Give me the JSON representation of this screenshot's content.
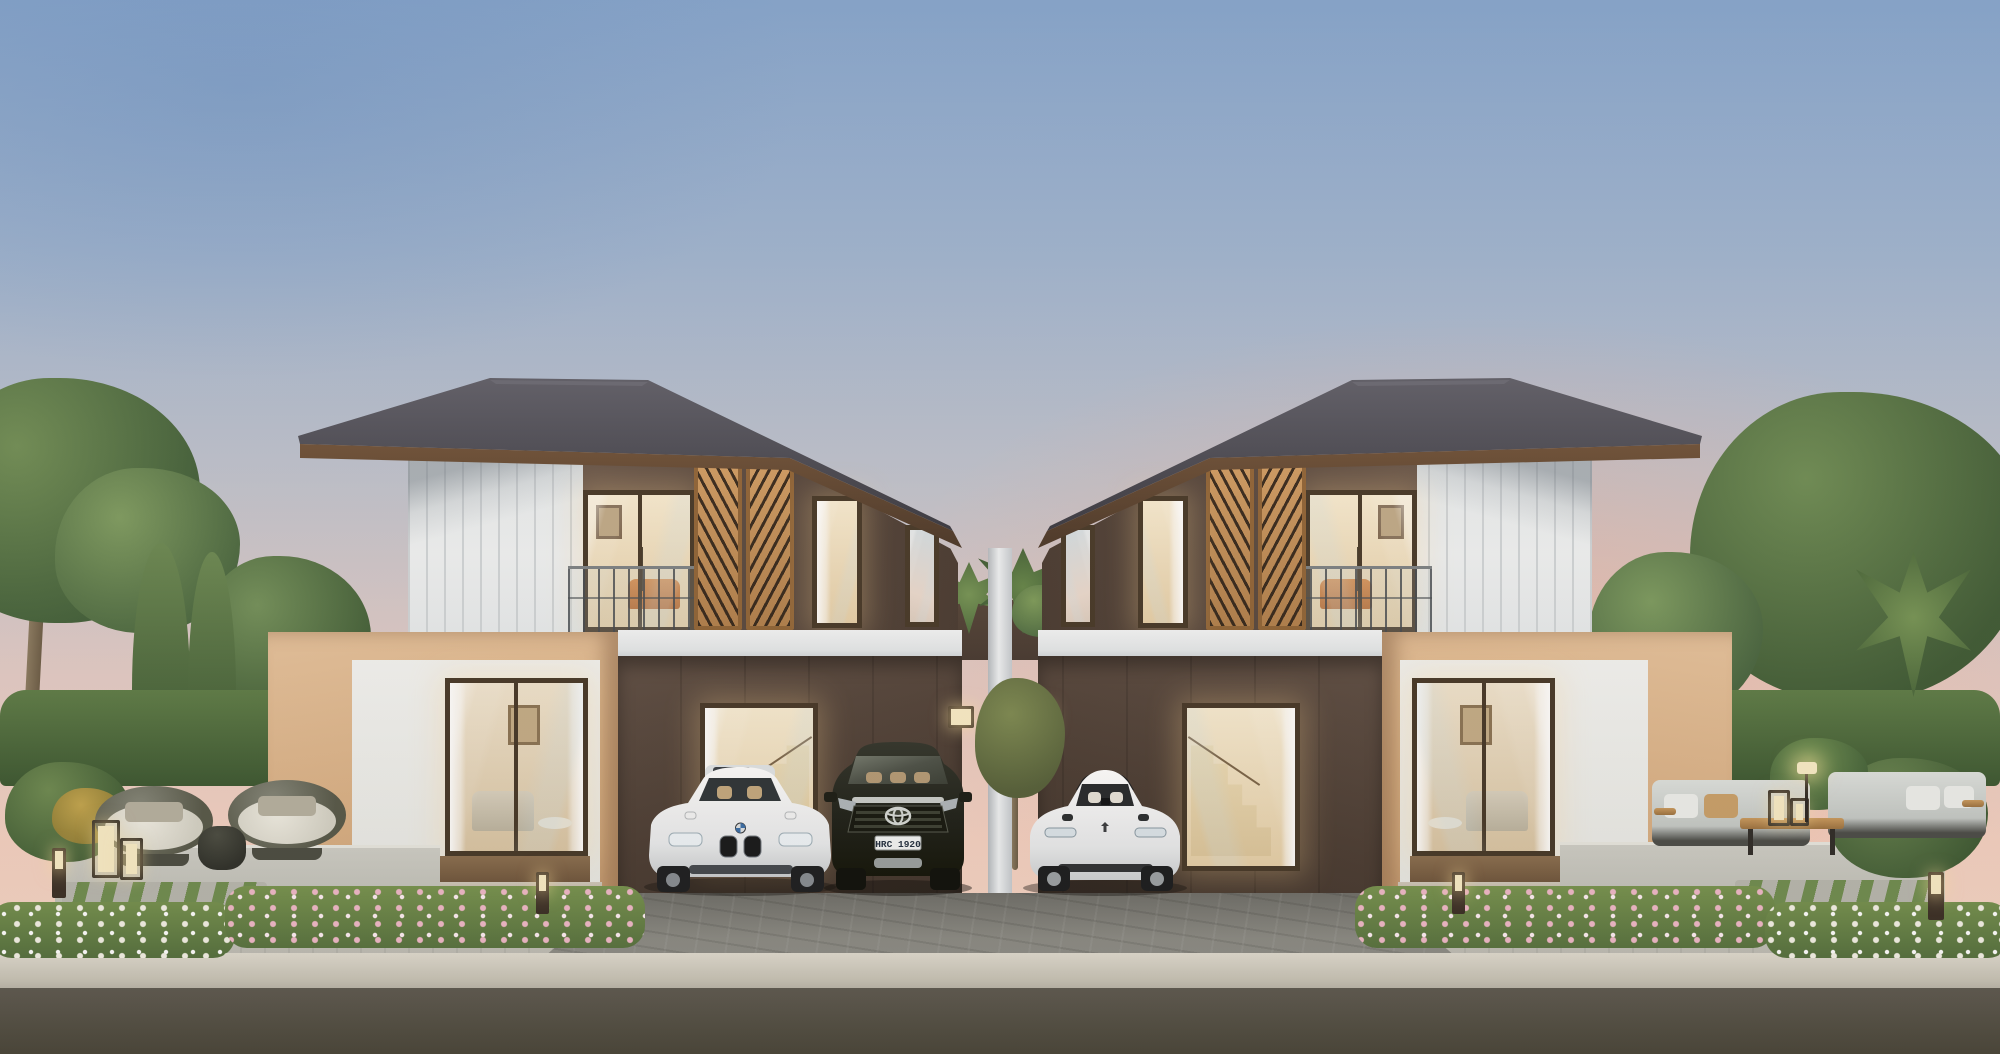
{
  "scene": {
    "title": "Twin modern two-storey semi-detached houses at dusk",
    "type": "architectural exterior rendering",
    "time_of_day": "dusk",
    "sky": {
      "top_color": "#7fa0c8",
      "mid_color": "#bfc2cc",
      "horizon_color": "#f6d2c2"
    },
    "houses": {
      "count": 2,
      "arrangement": "mirrored pair around central party wall",
      "roof": {
        "style": "hip roof",
        "color": "#4a4a53",
        "fascia_color": "#69503a"
      },
      "upper_floor": {
        "siding_color": "#e8ecee",
        "dark_wall_color": "#56463d",
        "wood_screen_color": "#c08a55",
        "features": [
          "vertical white siding",
          "wooden lattice screens",
          "balcony with metal railing",
          "lit bedroom interiors",
          "orange lounge sofa visible"
        ]
      },
      "ground_floor": {
        "frame_box_color": "#dcb48f",
        "band_color": "#eef1f2",
        "carport_wall_color": "#4a3c33",
        "features": [
          "large living-room window",
          "staircase window",
          "lit wall lamps",
          "double carport each"
        ]
      }
    },
    "vehicles": {
      "sedan": {
        "label": "white luxury sedan",
        "body_color": "#ffffff",
        "position": "left carport"
      },
      "suv": {
        "label": "black SUV",
        "body_color": "#1d1f18",
        "license_plate": "HRC 1920",
        "position": "left carport (right bay)"
      },
      "ev": {
        "label": "white electric sedan",
        "body_color": "#ffffff",
        "position": "right carport"
      }
    },
    "landscape": {
      "left_garden": [
        "tall tree",
        "two cypress trees",
        "trimmed hedge",
        "round wicker lounge chairs",
        "candle lanterns",
        "side table",
        "bollard light",
        "pink and white flower beds",
        "stepping-stone stripes"
      ],
      "right_garden": [
        "large trees",
        "palm plant",
        "banana-leaf plant",
        "two outdoor sofas",
        "wooden coffee table",
        "table lanterns",
        "floor lamp",
        "bollard light",
        "pink and white flower beds",
        "stepping-stone stripes"
      ],
      "center": [
        "tropical plants on party-wall parapet",
        "small tree at carport divider"
      ],
      "hardscape": [
        "grey paver driveway",
        "light paver sidewalk",
        "concrete curb",
        "asphalt road"
      ]
    },
    "palette": {
      "roof": "#4a4a53",
      "wood": "#c08a55",
      "beige": "#dcb48f",
      "dark_brown": "#4a3c33",
      "white_trim": "#eef1f2",
      "foliage": "#51703f",
      "flowers_pink": "#efb9c8",
      "driveway": "#8a8a84",
      "road": "#545047",
      "window_glow": "#f6e9cb"
    }
  }
}
